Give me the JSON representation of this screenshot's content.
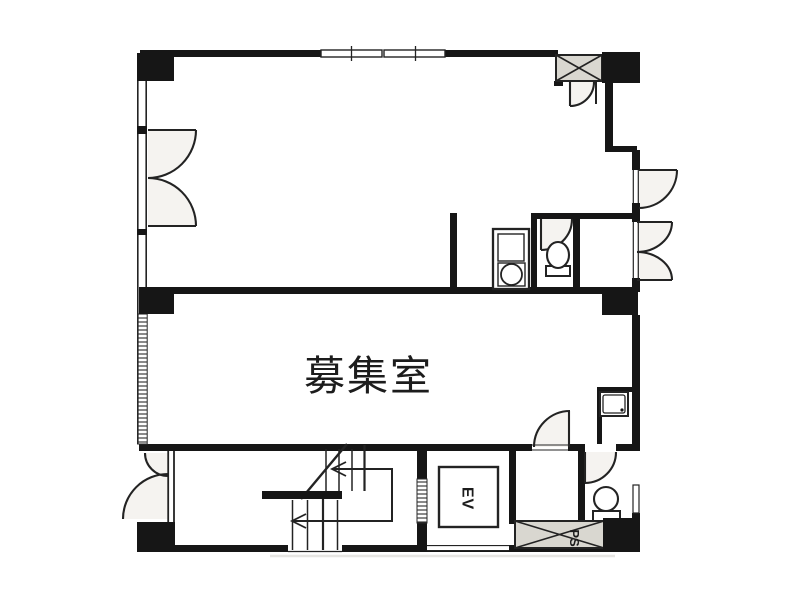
{
  "floorplan": {
    "labels": {
      "main_room": "募集室",
      "elevator": "EV",
      "pipe_shaft": "PS"
    },
    "colors": {
      "wall": "#161616",
      "line": "#232323",
      "shaft_fill": "#d9d7d0",
      "door_fill": "#eceae4",
      "background": "#ffffff"
    }
  }
}
